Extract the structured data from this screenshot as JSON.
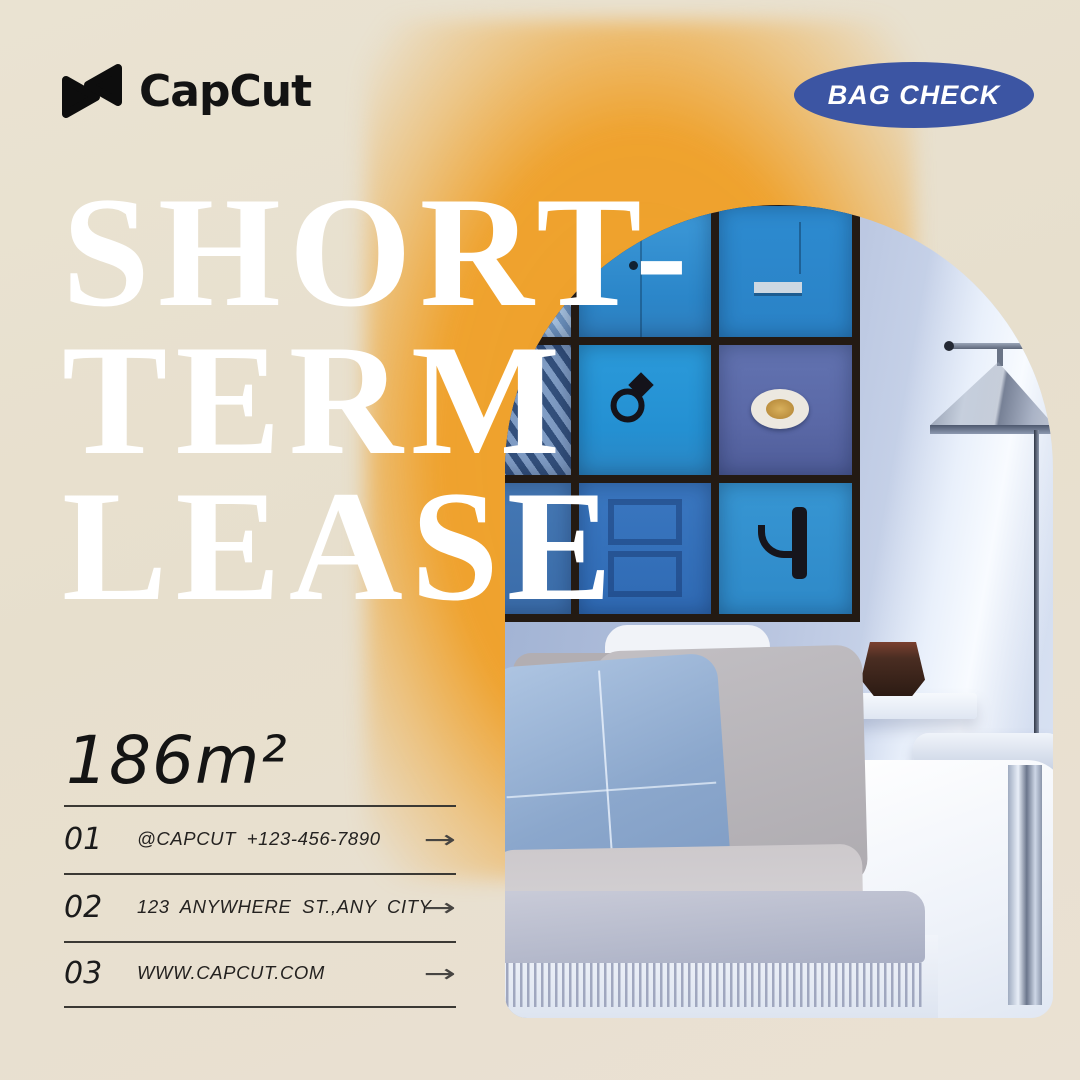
{
  "brand": {
    "logo_text": "CapCut",
    "badge_label": "BAG CHECK"
  },
  "headline": {
    "line1": "SHORT-",
    "line2": "TERM",
    "line3": "LEASE"
  },
  "area_label": "186m²",
  "contact_list": {
    "items": [
      {
        "index": "01",
        "label": "@CAPCUT +123-456-7890",
        "arrow": "→"
      },
      {
        "index": "02",
        "label": "123 ANYWHERE ST.,ANY CITY",
        "arrow": "→"
      },
      {
        "index": "03",
        "label": "WWW.CAPCUT.COM",
        "arrow": "→"
      }
    ]
  },
  "photo": {
    "description": "Arched photo of a living room: 3×3 gallery wall of framed blue Moroccan doors, grey floor lamp, white couch with blue pillow and fringed throw blanket"
  },
  "colors": {
    "background_beige": "#e8e1d1",
    "accent_orange": "#efa02c",
    "badge_blue": "#3c55a3",
    "headline_white": "#ffffff",
    "text_black": "#1a1a1a",
    "wall_blue": "#b3c0dc",
    "door_blue": "#2f8ed2"
  }
}
